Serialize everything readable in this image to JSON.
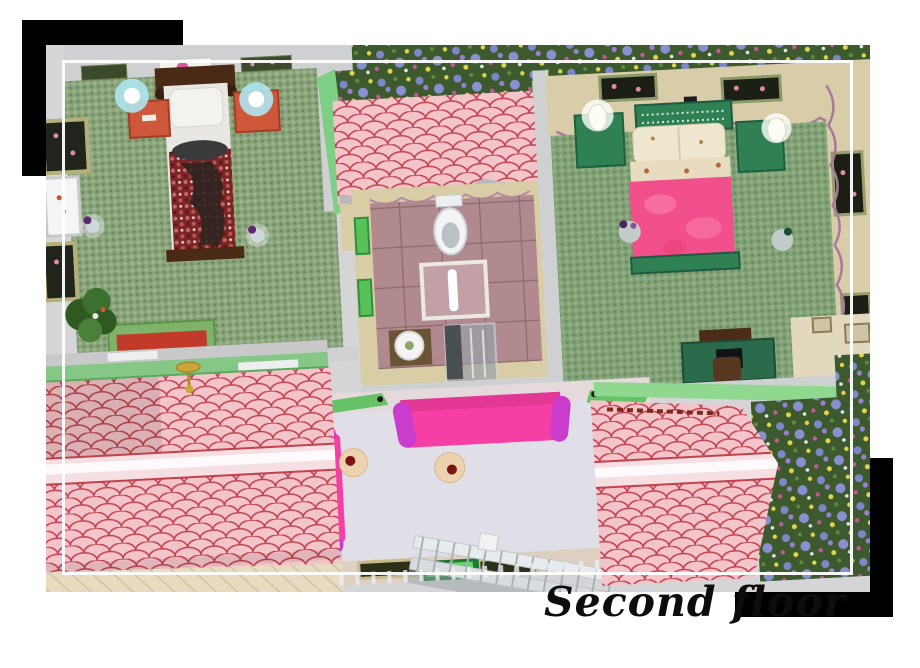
{
  "caption": {
    "text": "Second floor"
  },
  "artwork": {
    "rooms": [
      "bedroom-left",
      "bathroom",
      "bedroom-right",
      "lounge"
    ],
    "colors": {
      "page_bg": "#ffffff",
      "accent_black": "#000000",
      "frame_white": "#ffffff",
      "caption_color": "#0d0d0d",
      "roof_pink": "#f3c4ca",
      "roof_scallop_red": "#c0424f",
      "roof_trim_green": "#85c885",
      "carpet_green": "#8aa47c",
      "tile_mauve": "#b18a90",
      "sofa_hot_pink": "#f53fa5",
      "bed_pink": "#f2508c",
      "bed_maroon": "#7c2525",
      "wall_beige": "#d8cda8",
      "wall_gray": "#d2d2d4",
      "lounge_floor": "#e0dfe7",
      "nightstand_orange": "#d0583a",
      "furniture_green": "#2f8055"
    }
  }
}
